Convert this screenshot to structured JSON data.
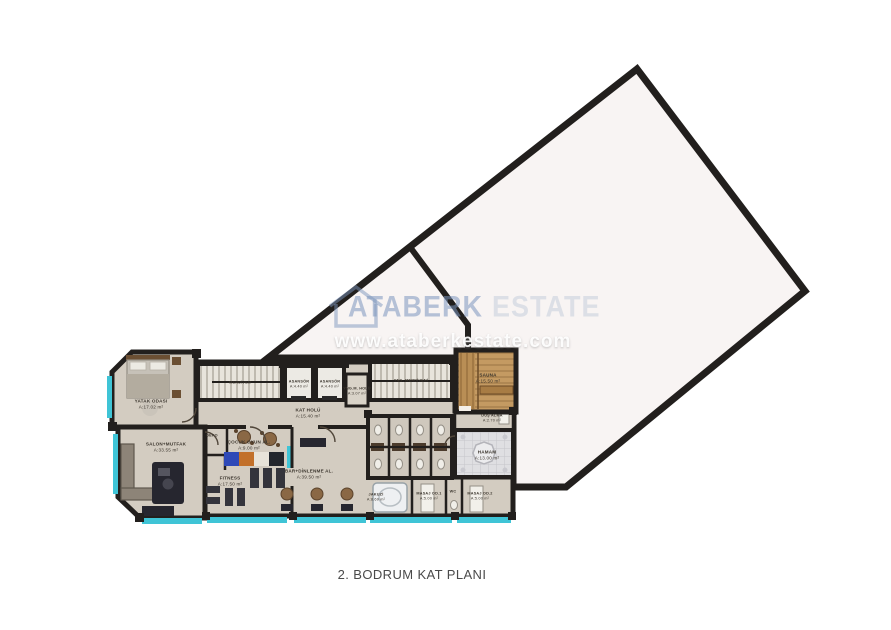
{
  "title": "2. BODRUM KAT PLANI",
  "watermark": {
    "brand_word1": "ATABERK",
    "brand_word2": "ESTATE",
    "website": "www.ataberkestate.com",
    "logo": "house-outline-icon"
  },
  "colors": {
    "wall": "#221f1d",
    "floor_beige": "#d3ccc1",
    "big_area_fill": "#f8f4f3",
    "accent_cyan": "#3fc4d6",
    "sauna_wood": "#c49a62",
    "hamam_tile": "#dfdfe2",
    "watermark_blue": "#7c96be"
  },
  "rooms": [
    {
      "name": "YATAK ODASI",
      "area": "A:17.02 m²"
    },
    {
      "name": "SALON+MUTFAK",
      "area": "A:33.55 m²"
    },
    {
      "name": "MERDİVEN",
      "area": ""
    },
    {
      "name": "ASANSÖR",
      "area": "A:4.40 m²"
    },
    {
      "name": "ASANSÖR",
      "area": "A:4.40 m²"
    },
    {
      "name": "YNG.M. HOLÜ",
      "area": "A:3.07 m²"
    },
    {
      "name": "YNG. MERDİVENİ",
      "area": ""
    },
    {
      "name": "KAT HOLÜ",
      "area": "A:15.40 m²"
    },
    {
      "name": "DEPO",
      "area": "A:1.90 m²"
    },
    {
      "name": "ÇOCUK OYUN AL.",
      "area": "A:9.00 m²"
    },
    {
      "name": "FITNESS",
      "area": "A:17.50 m²"
    },
    {
      "name": "BAR+DİNLENME AL.",
      "area": "A:39.50 m²"
    },
    {
      "name": "JAKUZİ",
      "area": "A:8.69 m²"
    },
    {
      "name": "MASAJ OD.1",
      "area": "A:5.00 m²"
    },
    {
      "name": "WC",
      "area": "A:1.95 m²"
    },
    {
      "name": "MASAJ OD.2",
      "area": "A:5.00 m²"
    },
    {
      "name": "HAMAM",
      "area": "A:13.00 m²"
    },
    {
      "name": "SAUNA",
      "area": "A:15.50 m²"
    },
    {
      "name": "DUŞ ALMA",
      "area": "A:2.70 m²"
    }
  ]
}
